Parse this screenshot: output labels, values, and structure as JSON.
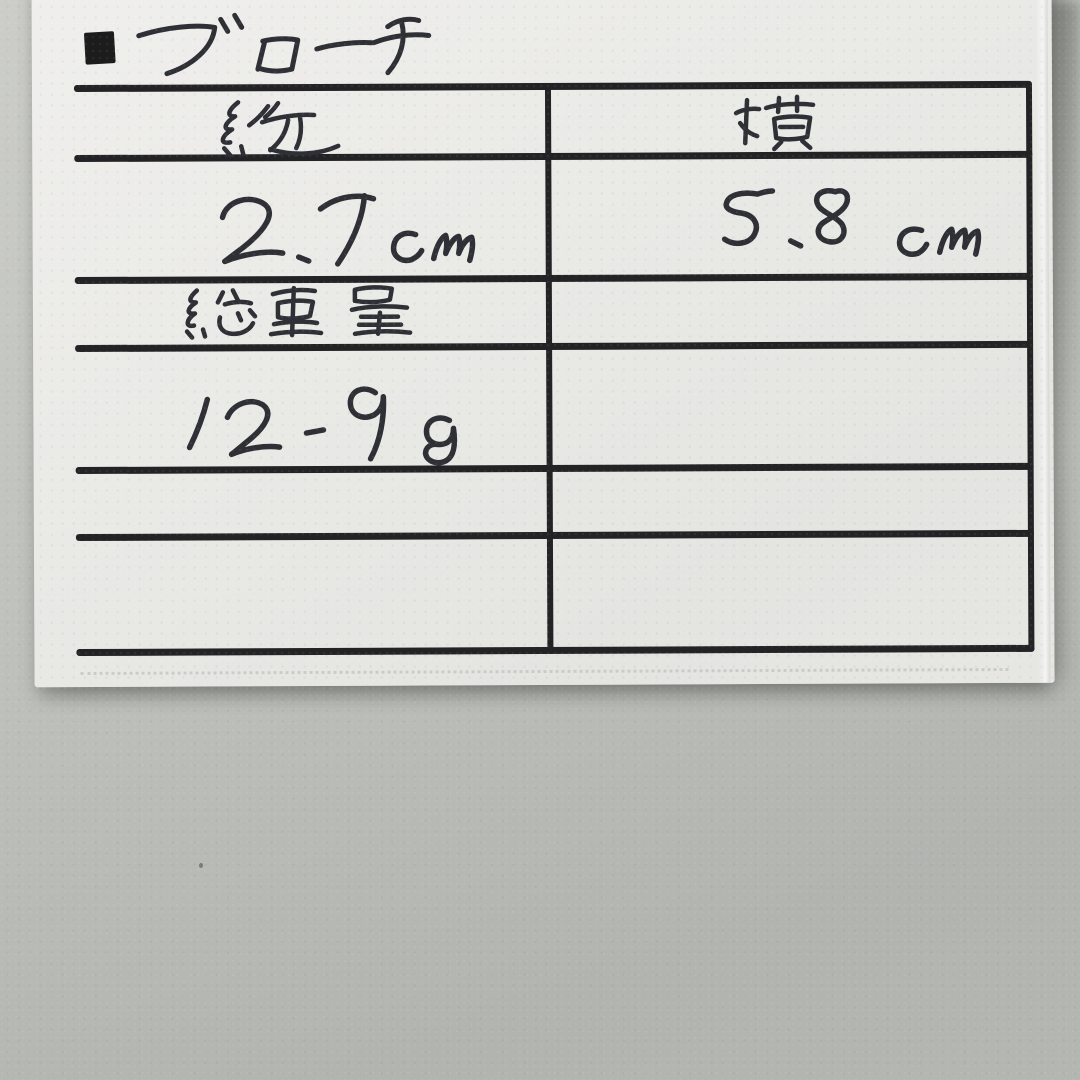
{
  "note": {
    "bullet": "■",
    "title": "ブローチ",
    "table": {
      "header_left": "縦",
      "header_right": "横",
      "value_left": "2.7 cm",
      "value_right": "5.8 cm",
      "weight_label": "総重量",
      "weight_value": "12.9 g",
      "empty_rows": 2
    },
    "colors": {
      "wall": "#bcbeb9",
      "card": "#e9e9e6",
      "ruled_lines": "#232325",
      "pen_ink": "#2e3036"
    }
  }
}
